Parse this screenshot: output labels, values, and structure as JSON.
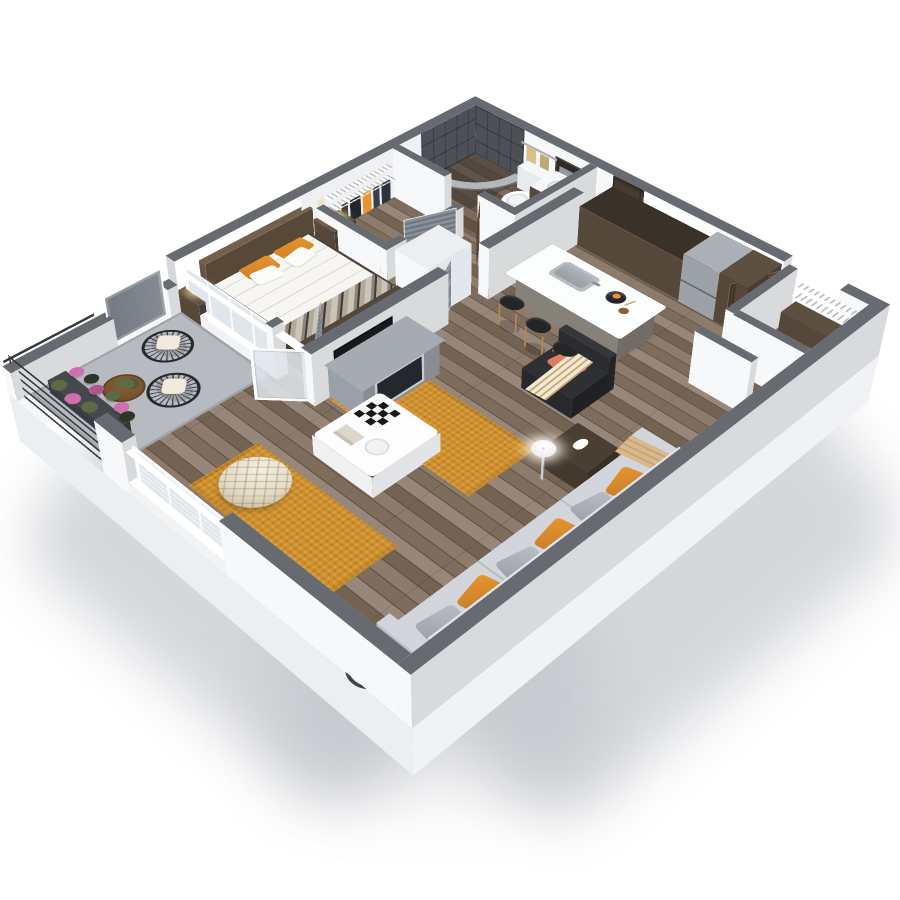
{
  "scene": {
    "type": "isometric-3d-floor-plan",
    "description": "3D dollhouse-style rendering of a one-bedroom apartment floor plan on a white background",
    "background": "#ffffff",
    "rooms": [
      {
        "id": "bathroom",
        "name": "Bathroom",
        "features": [
          "dark-tile-walk-in-shower",
          "curved-curtain-rod",
          "toilet",
          "wood-vanity-with-sink",
          "mirror",
          "towel-bar-with-towels"
        ]
      },
      {
        "id": "walk-in-closet",
        "name": "Walk-in Closet",
        "features": [
          "white-wire-shelving",
          "hanging-clothes",
          "louvered-door"
        ]
      },
      {
        "id": "bedroom",
        "name": "Bedroom",
        "features": [
          "double-bed-white-duvet",
          "orange-accent-pillows",
          "brown-headboard",
          "nightstands",
          "wall-sconces",
          "patterned-foot-runner",
          "window-wall-to-balcony"
        ]
      },
      {
        "id": "hallway",
        "name": "Hallway",
        "features": [
          "gray-interior-doors",
          "white-utility-column"
        ]
      },
      {
        "id": "kitchen",
        "name": "Kitchen",
        "features": [
          "dark-wood-cabinets",
          "refrigerator",
          "white-island-with-sink",
          "three-black-bar-stools",
          "fruit-bowl",
          "vase"
        ]
      },
      {
        "id": "entry",
        "name": "Entry",
        "features": [
          "dark-wood-entry-door-open",
          "entry-closet-shelving"
        ]
      },
      {
        "id": "living-room",
        "name": "Living Room",
        "features": [
          "gray-sofa-orange-pillows",
          "black-armchair-salmon-pillow",
          "tan-throw",
          "white-coffee-table-checkerboard",
          "tufted-cream-ottoman",
          "mustard-rug",
          "fireplace-console",
          "tv-half-wall",
          "globe-floor-lamp",
          "wood-side-table-cat-figurine",
          "round-glass-table",
          "triple-window"
        ]
      },
      {
        "id": "balcony",
        "name": "Balcony",
        "features": [
          "black-metal-slat-railing",
          "two-wire-chairs-white-cushions",
          "round-wood-table-with-plant",
          "flower-planters",
          "concrete-floor",
          "french-glass-door-open",
          "gray-balcony-door"
        ]
      }
    ]
  },
  "palette": {
    "background": "#ffffff",
    "wallCap": "#676b71",
    "wallWhite": "#f7f8fa",
    "wallLight": "#eef0f3",
    "slabSide": "#f0f2f5",
    "slabFront": "#eceff2",
    "slabWest": "#f5f7f9",
    "floorWood1": "#8d7b6b",
    "floorWood2": "#7e6c5c",
    "floorWood3": "#97867a",
    "floorWood4": "#746352",
    "floorLine": "#5c4e3f",
    "bathTint": "rgba(60,42,26,0.30)",
    "balconyFloor": "#b7bbc1",
    "railDark": "#34373b",
    "tile": "#4b5157",
    "curtain": "rgba(196,201,207,0.85)",
    "doorGray1": "#858b92",
    "doorGray2": "#747a81",
    "doorDark1": "#6b5640",
    "doorDark2": "#51402d",
    "glassDoor": "rgba(223,230,235,0.85)",
    "glass": "#dfe6ec",
    "frameWhite": "#fbfcfd",
    "walnut": "#594b3d",
    "walnutDark": "#463b2f",
    "counterDark": "#393229",
    "fridge": "#9ba1a7",
    "islandBase": "#8d887f",
    "islandTop": "#fcfdfd",
    "sinkSteel": "#b7bdc2",
    "stoolSeat": "#232527",
    "stoolLeg": "#b9894f",
    "rug": "#cf9130",
    "duvet": "#f7f6f3",
    "pillowOrange": "#e8942f",
    "pillowWhite": "#fbfbfa",
    "headboard": "#6d5a46",
    "bedFrame": "#4c4137",
    "sofa": "#c6cad0",
    "sofaBack": "#d3d7db",
    "pillowGray": "#b9bec5",
    "armchair": "#2b2d30",
    "salmon": "#e5866a",
    "throwTan": "#d9b98b",
    "cream": "#f0e9d8",
    "pouf": "#e3dac4",
    "fireplace": "#9aa0a7",
    "fireboxDark": "#24272b",
    "tv": "#17191c",
    "lampGlow": "rgba(247,217,164,0.85)",
    "towel": "#d9bf8a",
    "mirrorGlass": "#a9b1b8",
    "clothes1": "#2d333c",
    "clothes2": "#394049",
    "clothes3": "#22262b",
    "plantGreen": "#5c6a45",
    "flowerPink": "#cf6fae",
    "flowerMagenta": "#b05590",
    "woodTable": "#8a5f35",
    "catWhite": "#fdfdfd",
    "toilet": "#f4f5f7",
    "shadow": "rgba(178,183,190,0.55)"
  }
}
